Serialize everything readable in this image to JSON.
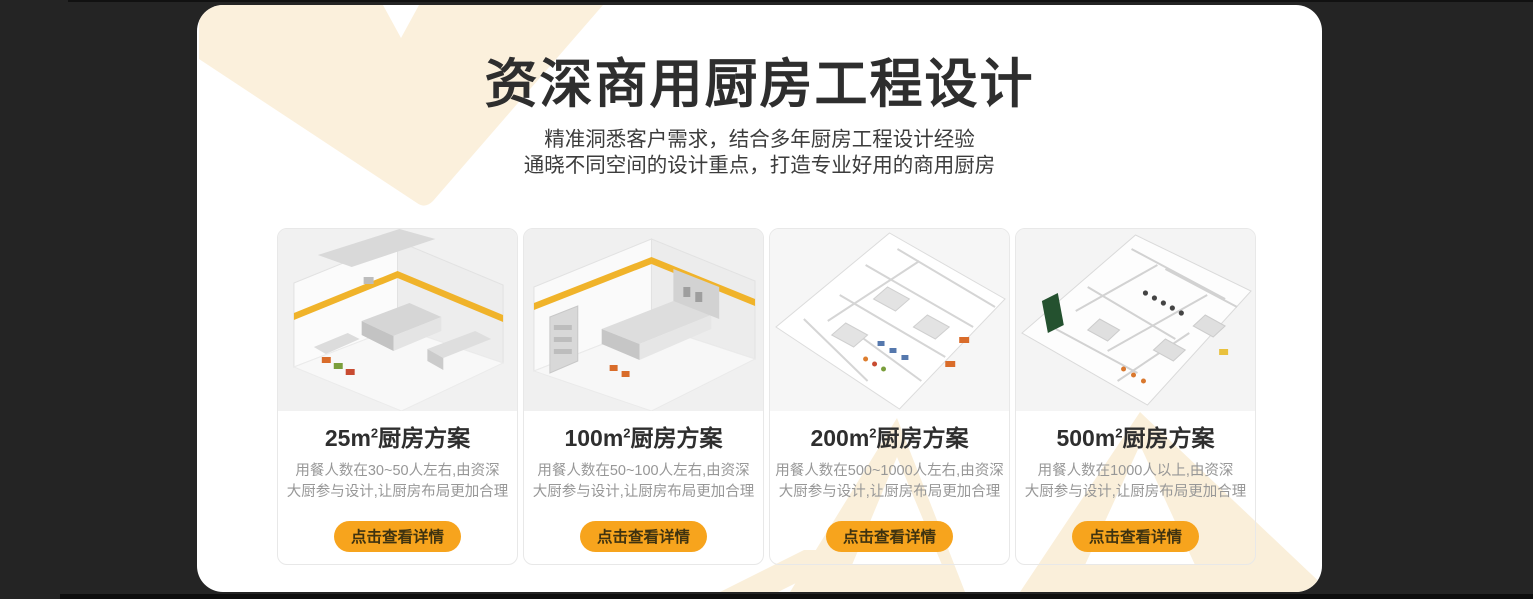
{
  "section": {
    "title": "资深商用厨房工程设计",
    "subtitle_line1": "精准洞悉客户需求，结合多年厨房工程设计经验",
    "subtitle_line2": "通晓不同空间的设计重点，打造专业好用的商用厨房"
  },
  "cards": [
    {
      "title_area": "25m",
      "title_sup": "2",
      "title_suffix": "厨房方案",
      "desc_line1": "用餐人数在30~50人左右,由资深",
      "desc_line2": "大厨参与设计,让厨房布局更加合理",
      "button_label": "点击查看详情"
    },
    {
      "title_area": "100m",
      "title_sup": "2",
      "title_suffix": "厨房方案",
      "desc_line1": "用餐人数在50~100人左右,由资深",
      "desc_line2": "大厨参与设计,让厨房布局更加合理",
      "button_label": "点击查看详情"
    },
    {
      "title_area": "200m",
      "title_sup": "2",
      "title_suffix": "厨房方案",
      "desc_line1": "用餐人数在500~1000人左右,由资深",
      "desc_line2": "大厨参与设计,让厨房布局更加合理",
      "button_label": "点击查看详情"
    },
    {
      "title_area": "500m",
      "title_sup": "2",
      "title_suffix": "厨房方案",
      "desc_line1": "用餐人数在1000人以上,由资深",
      "desc_line2": "大厨参与设计,让厨房布局更加合理",
      "button_label": "点击查看详情"
    }
  ],
  "colors": {
    "page_background": "#242424",
    "panel_background": "#ffffff",
    "accent_cream": "#FBF0DC",
    "button_orange": "#F7A41D",
    "title_text": "#2e2e2e",
    "description_text": "#979797"
  }
}
